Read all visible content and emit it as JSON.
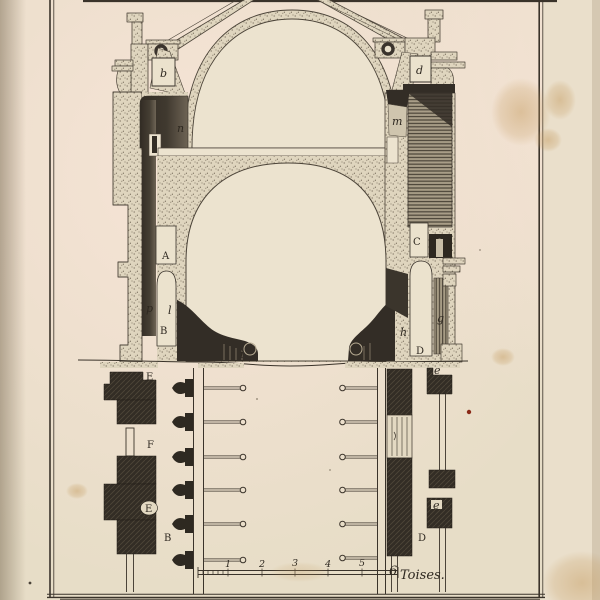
{
  "artwork": {
    "kind": "engraved architectural plate (building cross-section with foundation plan and scale bar)",
    "section_labels": {
      "b": "b",
      "d": "d",
      "n": "n",
      "m": "m",
      "A": "A",
      "B": "B",
      "C": "C",
      "D": "D",
      "p": "p",
      "l": "l",
      "g": "g",
      "h": "h",
      "i": "i"
    },
    "plan_labels": {
      "E_top": "E",
      "F": "F",
      "E_oval": "E",
      "B": "B",
      "D": "D",
      "e_top": "e",
      "e_mid": "e"
    },
    "scale_bar": {
      "ticks": [
        "1",
        "2",
        "3",
        "4",
        "5"
      ],
      "last_tick": "6",
      "unit_label": "Toises."
    },
    "colors": {
      "paper": "#e7ddc7",
      "ink": "#3a332a",
      "wash_dark": "#352f27",
      "wash_mid": "#6b6153",
      "stain": "#c8a06a",
      "red_fleck": "#8a2a18"
    }
  }
}
